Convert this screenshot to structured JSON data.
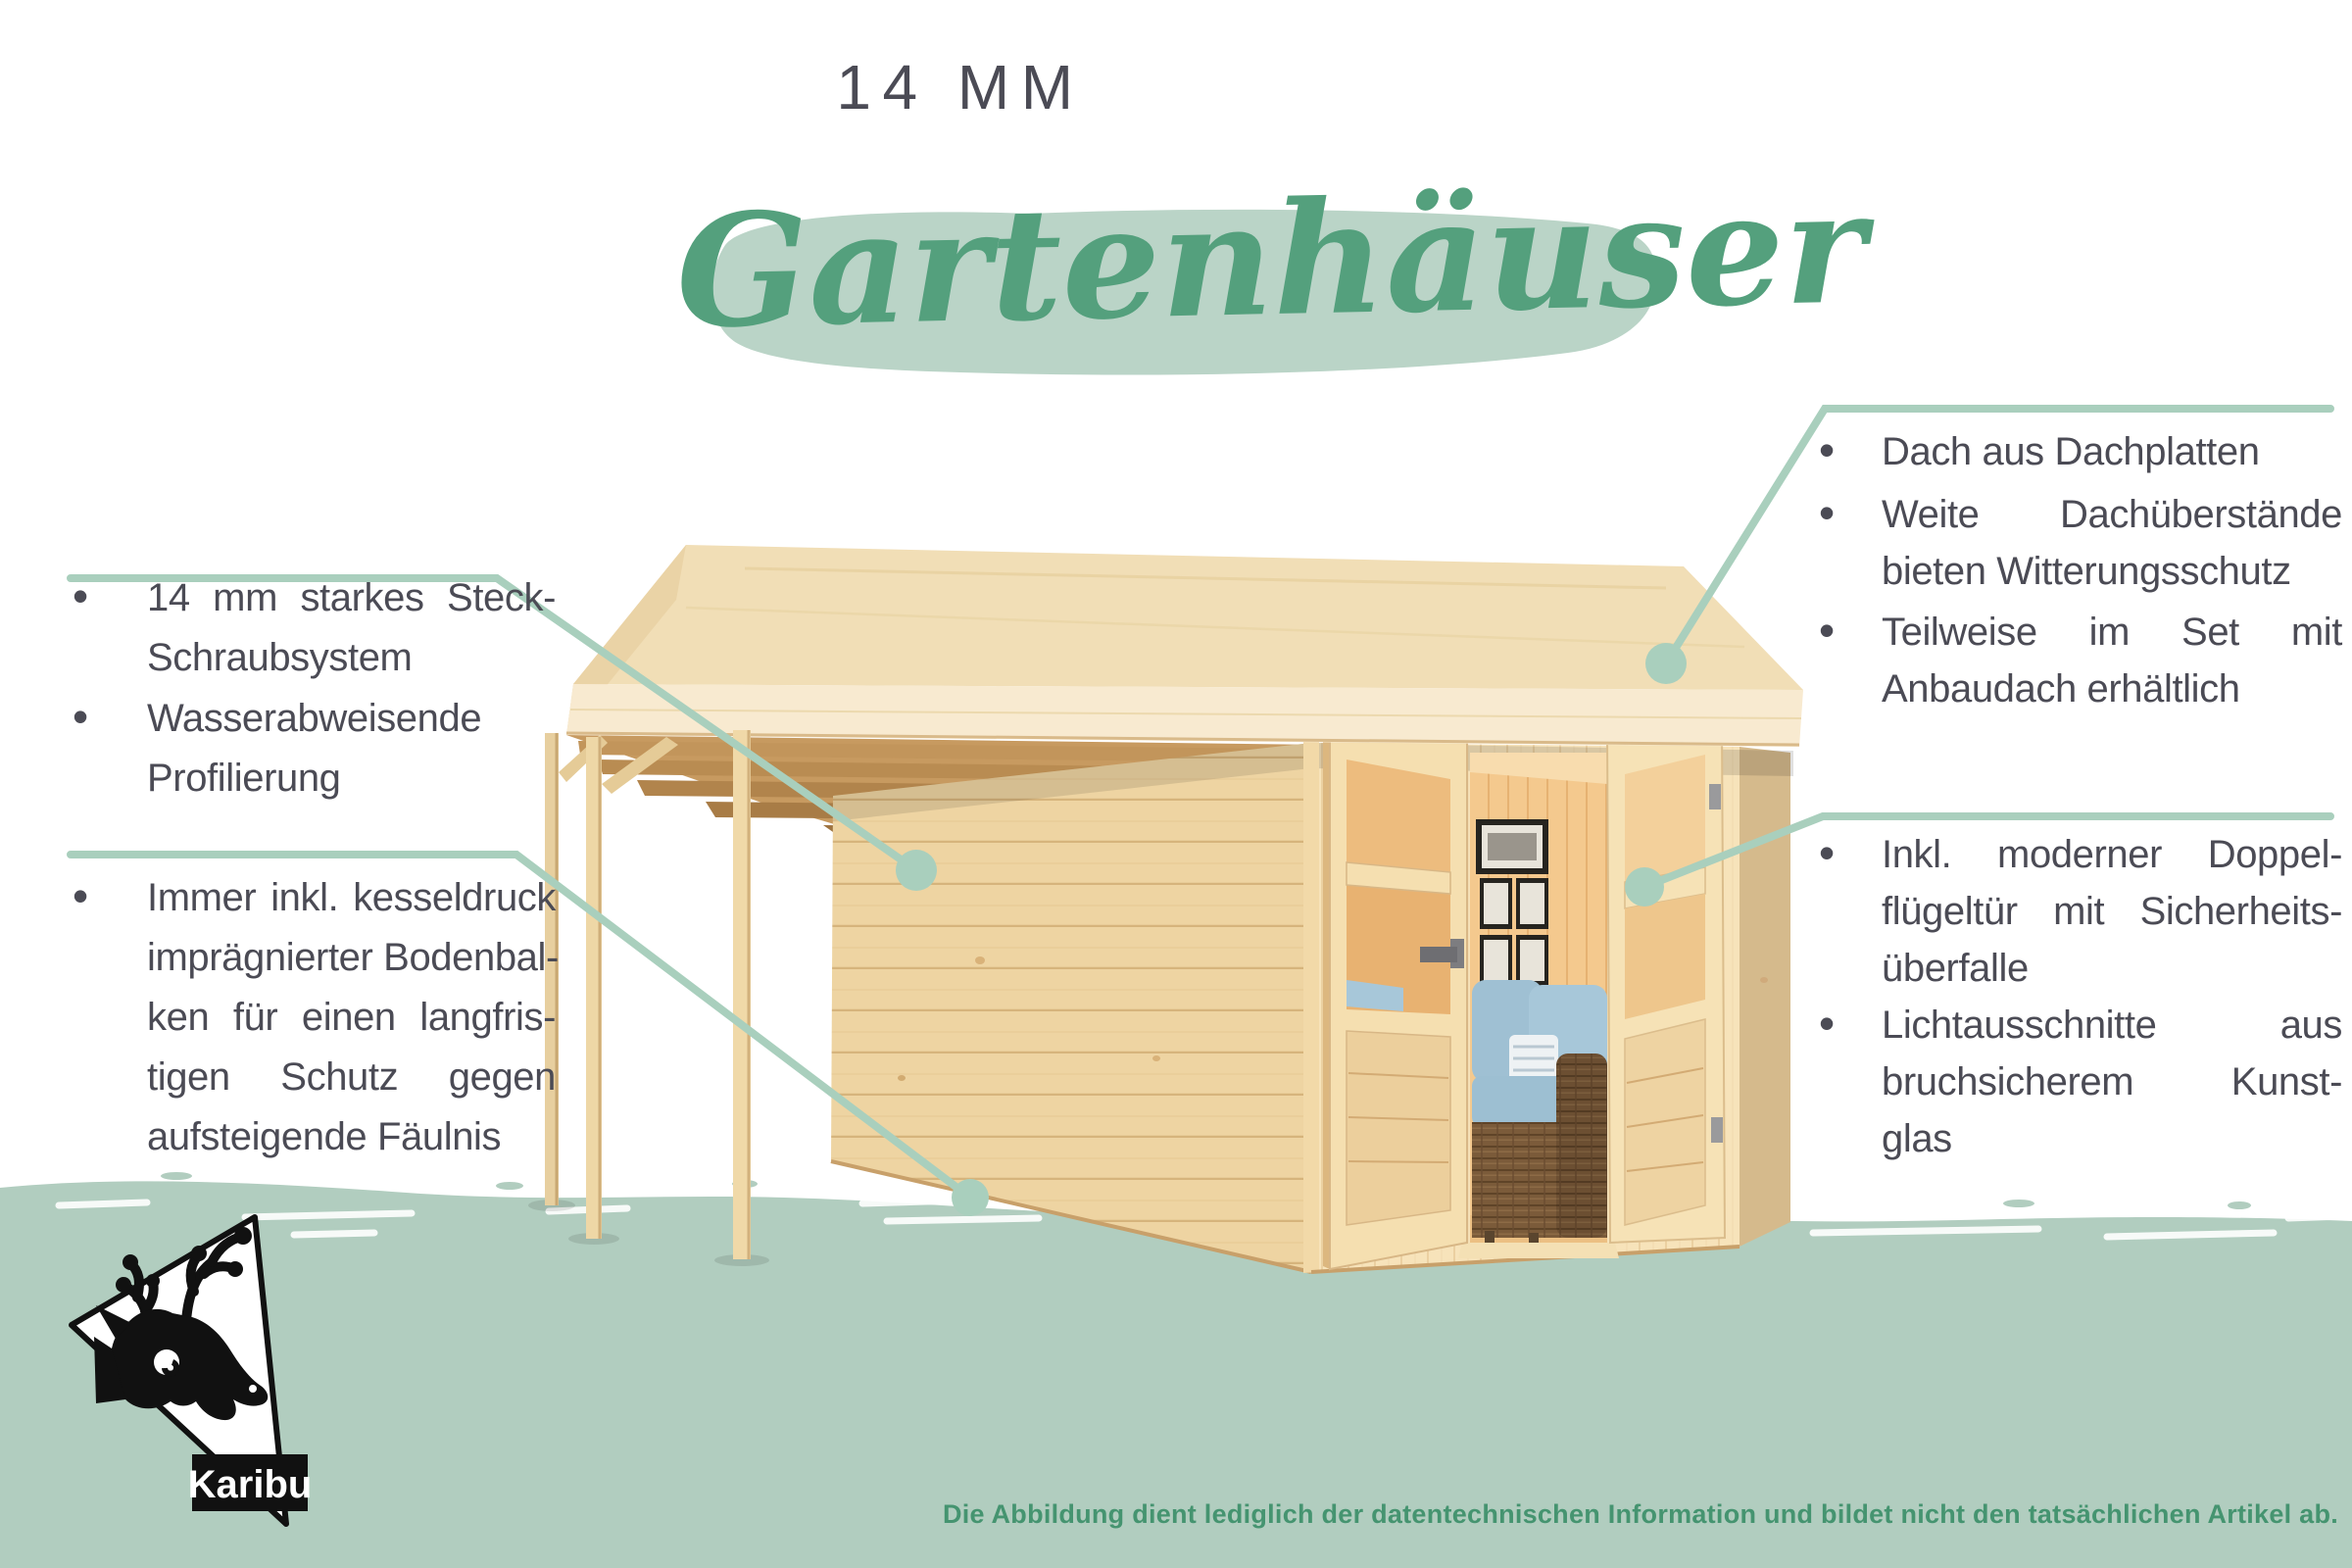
{
  "header": {
    "title": "14 MM",
    "headline": "Gartenhäuser"
  },
  "ui": {
    "bullet_char": "•"
  },
  "features": {
    "left": [
      {
        "lines": [
          "14 mm starkes Steck-",
          "Schraubsystem"
        ]
      },
      {
        "lines": [
          "Wasserabweisende",
          "Profilierung"
        ]
      },
      {
        "lines": [
          "Immer inkl. kesseldruck",
          "imprägnierter Bodenbal-",
          "ken für einen langfris-",
          "tigen Schutz gegen",
          "aufsteigende Fäulnis"
        ]
      }
    ],
    "right": [
      {
        "lines": [
          "Dach aus Dachplatten"
        ]
      },
      {
        "lines": [
          "Weite Dachüberstände",
          "bieten Witterungsschutz"
        ]
      },
      {
        "lines": [
          "Teilweise im Set mit",
          "Anbaudach erhältlich"
        ]
      },
      {
        "lines": [
          "Inkl. moderner Doppel-",
          "flügeltür mit Sicherheits-",
          "überfalle"
        ]
      },
      {
        "lines": [
          "Lichtausschnitte aus",
          "bruchsicherem Kunst-",
          "glas"
        ]
      }
    ]
  },
  "footer": {
    "disclaimer": "Die Abbildung dient lediglich der datentechnischen Information und bildet nicht den tatsächlichen Artikel ab."
  },
  "logo": {
    "brand": "Karibu"
  },
  "colors": {
    "text": "#4b4b55",
    "accent_script_green": "#54a07d",
    "brush_stroke": "#bad4c7",
    "leader_line": "#a9cfbd",
    "bottom_band": "#b1cdbf",
    "disclaimer_green": "#459470",
    "wood_light": "#f5dfb0",
    "wood_mid": "#eed4a2",
    "wood_dark": "#c89b62",
    "cushion_blue": "#a7c7d9",
    "wicker_brown": "#7b5b3a"
  }
}
